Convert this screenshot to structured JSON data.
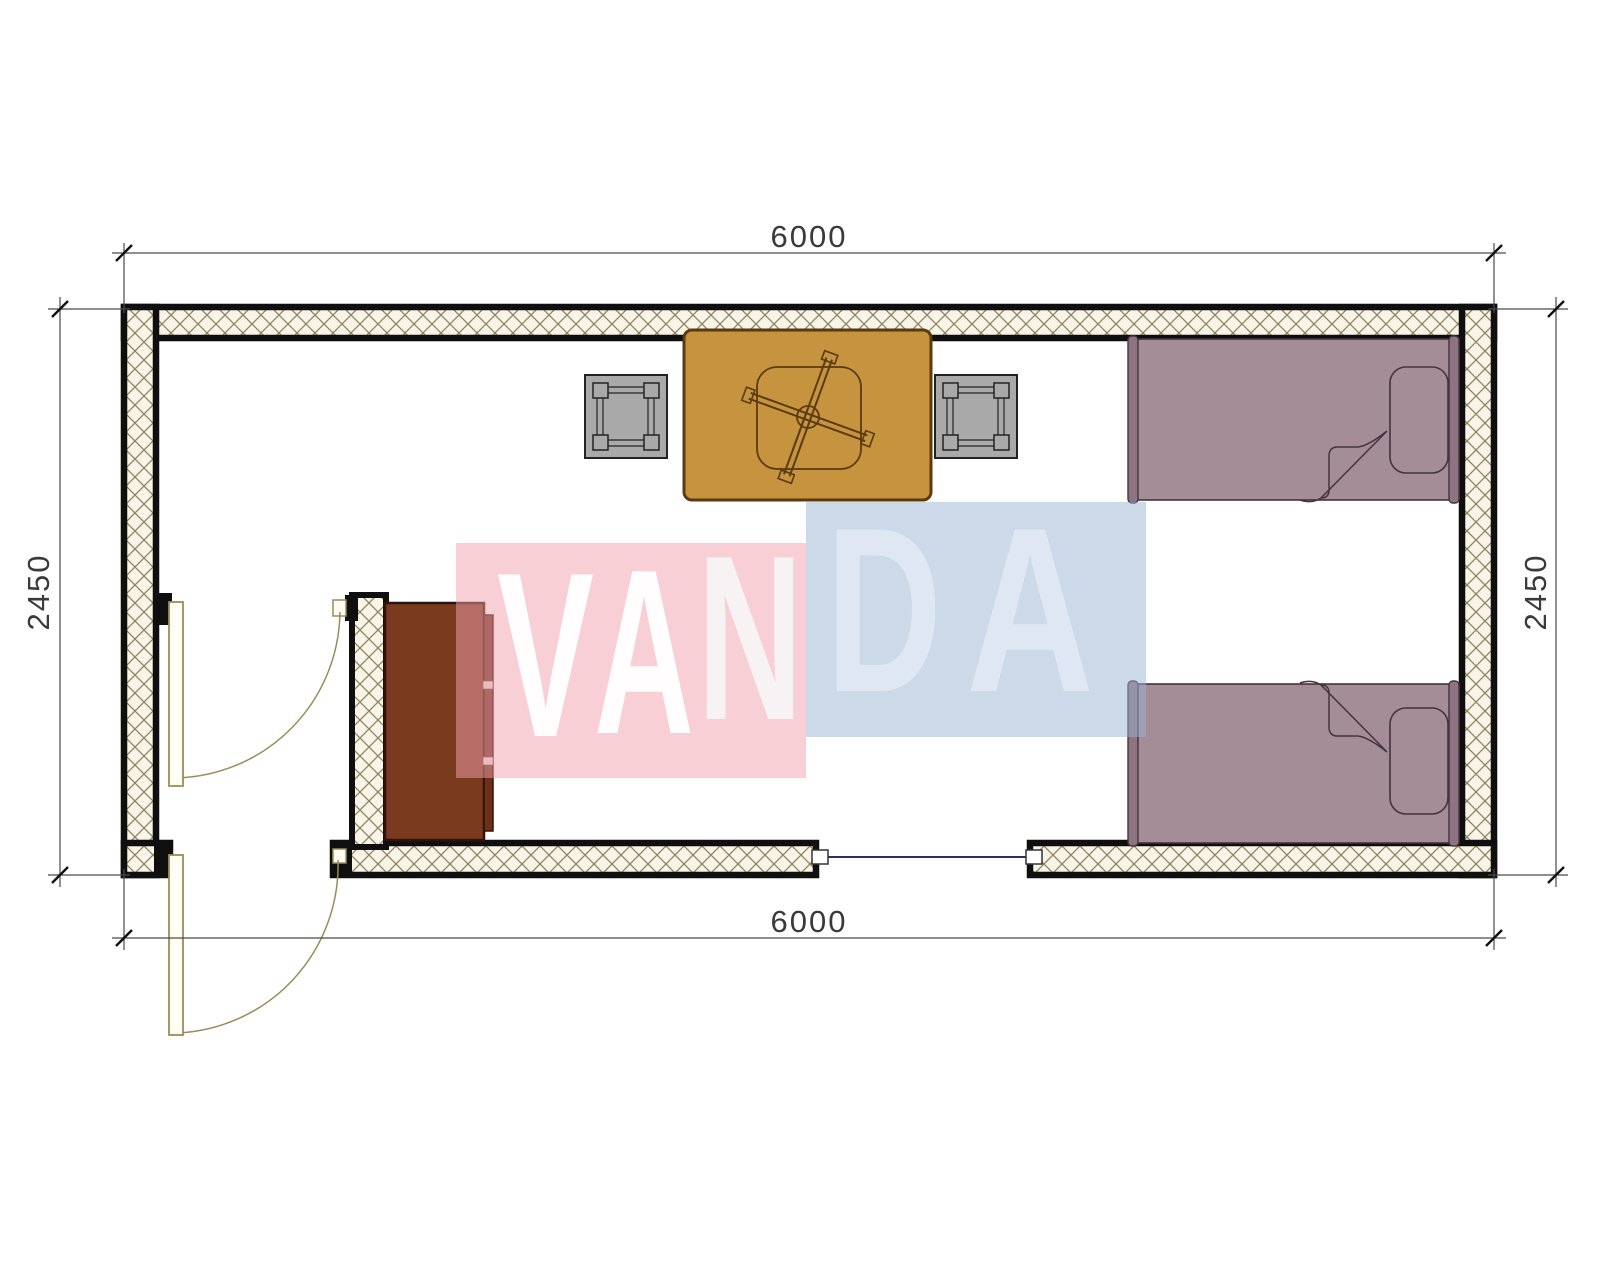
{
  "watermark": {
    "text": "VANDA",
    "letters": [
      {
        "char": "V"
      },
      {
        "char": "A"
      },
      {
        "char": "N"
      },
      {
        "char": "D"
      },
      {
        "char": "A"
      }
    ]
  },
  "dimensions": {
    "top": "6000",
    "bottom": "6000",
    "left": "2450",
    "right": "2450"
  },
  "plan": {
    "width_mm": 6000,
    "depth_mm": 2450,
    "furniture": [
      "single-bed",
      "single-bed",
      "pedestal-table",
      "stool",
      "stool",
      "cabinet"
    ],
    "openings": [
      "exterior-door",
      "interior-door",
      "window"
    ]
  },
  "colors": {
    "wall_hatch_line": "#8f835f",
    "wall_hatch_bg": "#f8f4e8",
    "wall_border": "#0f0f0f",
    "bed": "#a48d97",
    "table": "#c6933f",
    "stool": "#a9a9a9",
    "cabinet": "#7a3a1e",
    "door": "#9a8c5a",
    "window": "#2d2d64",
    "watermark_pink": "#f3a0ae",
    "watermark_blue": "#99b3d1",
    "dimension_text": "#3a3a3a"
  }
}
